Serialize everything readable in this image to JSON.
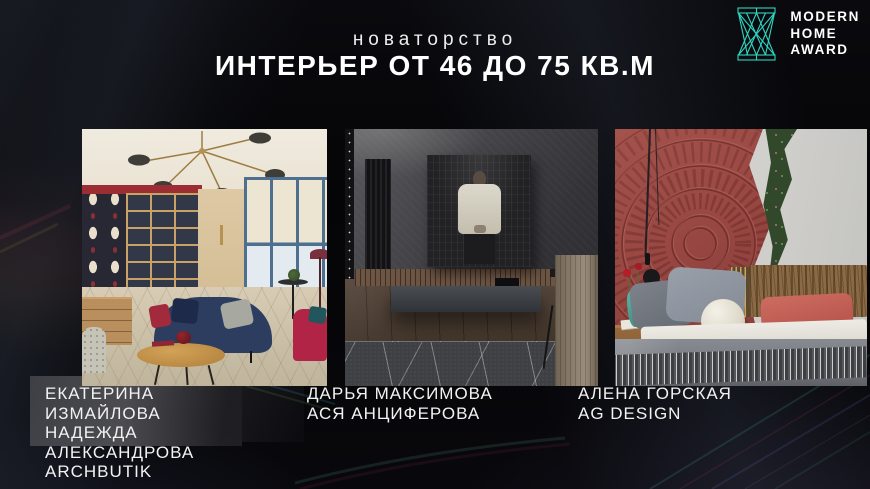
{
  "slide": {
    "category": "новаторство",
    "title": "ИНТЕРЬЕР ОТ 46 ДО 75 КВ.М"
  },
  "logo": {
    "lines": [
      "MODERN",
      "HOME",
      "AWARD"
    ],
    "icon": "hourglass-lattice-icon",
    "accent_color": "#2FD5C0"
  },
  "nominees": [
    {
      "lines": [
        "ЕКАТЕРИНА",
        "ИЗМАЙЛОВА",
        "НАДЕЖДА",
        "АЛЕКСАНДРОВА",
        "ARCHBUTIK"
      ],
      "photo_alt": "Living room with navy sofa, red armchair, patterned wallpaper, wooden shelving and brass chandelier"
    },
    {
      "lines": [
        "ДАРЬЯ МАКСИМОВА",
        "АСЯ АНЦИФЕРОВА"
      ],
      "photo_alt": "Dark grey interior with black-and-white artwork of a man above a floating console and patterned rug"
    },
    {
      "lines": [
        "АЛЕНА ГОРСКАЯ",
        "AG DESIGN"
      ],
      "photo_alt": "Bedroom with carved terracotta mandala wall, vertical plant strip, wooden headboard and grey bedding"
    }
  ],
  "colors": {
    "background": "#07070A",
    "accent_teal": "#2FD5C0",
    "text": "#F2F2F2"
  }
}
